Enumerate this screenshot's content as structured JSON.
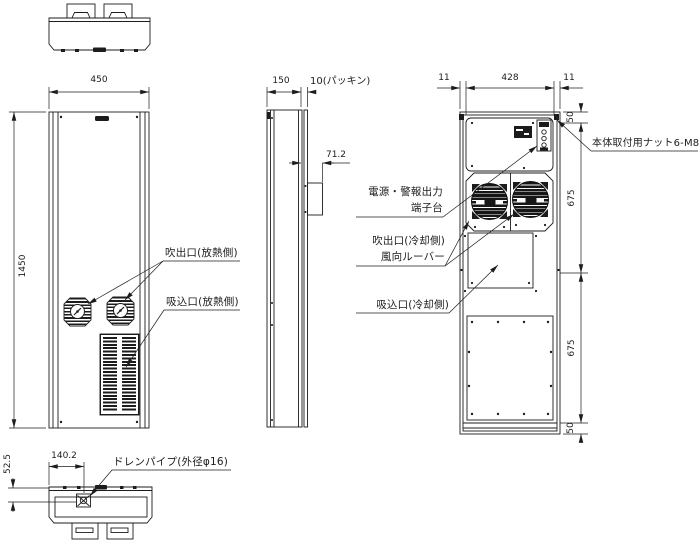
{
  "drawing": {
    "ink_color": "#1c1c1c",
    "background_color": "#ffffff"
  },
  "dimensions": {
    "front_width": "450",
    "front_height": "1450",
    "side_depth": "150",
    "packing": "10(パッキン)",
    "terminal_cover_offset": "71.2",
    "drain_offset_x": "140.2",
    "drain_offset_y": "52.5",
    "rear_left_margin": "11",
    "rear_bolt_span": "428",
    "rear_right_margin": "11",
    "rear_top_pitch": "50",
    "rear_upper_pitch": "675",
    "rear_lower_pitch": "675",
    "rear_bottom_pitch": "50"
  },
  "labels": {
    "front_outlet": "吹出口(放熱側)",
    "front_inlet": "吸込口(放熱側)",
    "drain_pipe": "ドレンパイプ(外径φ16)",
    "power_terminal_line1": "電源・警報出力",
    "power_terminal_line2": "端子台",
    "rear_outlet_line1": "吹出口(冷却側)",
    "rear_outlet_line2": "風向ルーバー",
    "rear_inlet": "吸込口(冷却側)",
    "mounting_nut": "本体取付用ナット6-M8"
  }
}
